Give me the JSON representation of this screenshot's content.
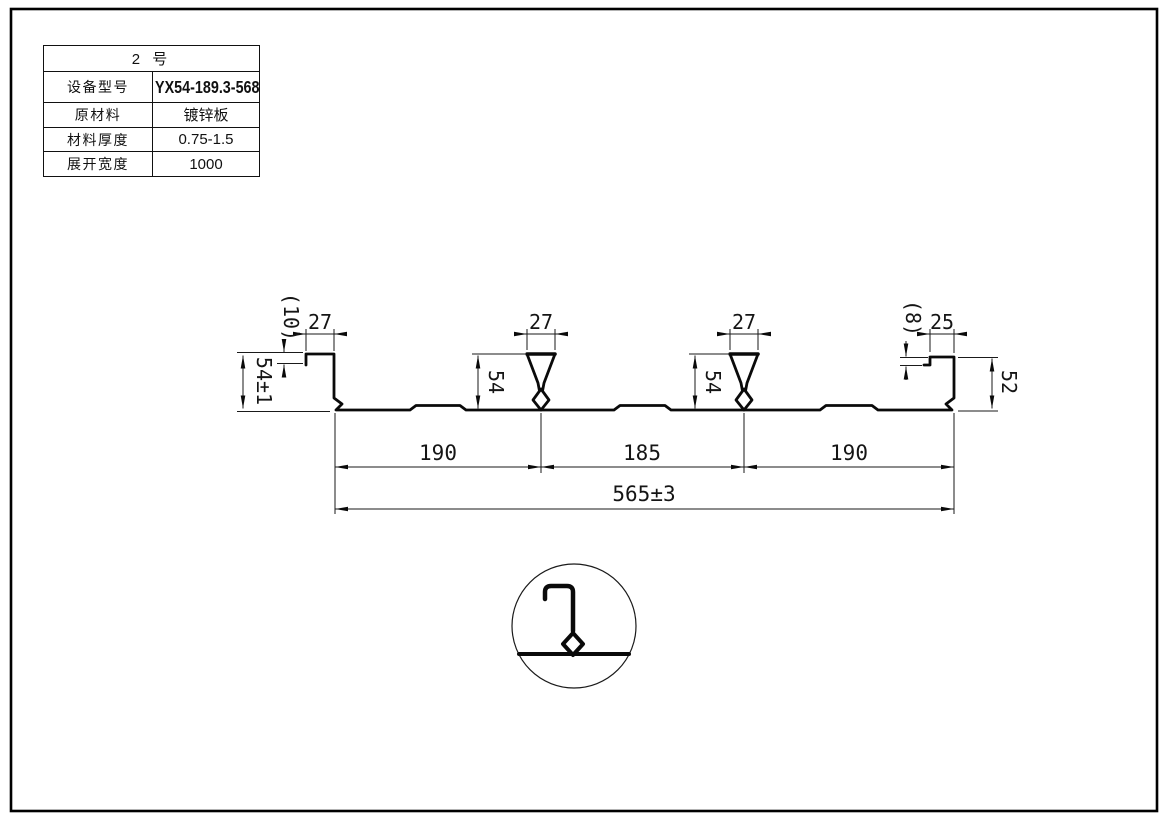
{
  "title_block": {
    "header": "2  号",
    "rows": [
      {
        "label": "设备型号",
        "value": "YX54-189.3-568"
      },
      {
        "label": "原材料",
        "value": "镀锌板"
      },
      {
        "label": "材料厚度",
        "value": "0.75-1.5"
      },
      {
        "label": "展开宽度",
        "value": "1000"
      }
    ]
  },
  "dims": {
    "left_edge_lip": "(10)",
    "left_flange_width": "27",
    "left_edge_height": "54±1",
    "rib1_top_width": "27",
    "rib1_height": "54",
    "rib2_top_width": "27",
    "rib2_height": "54",
    "right_edge_lip": "(8)",
    "right_flange_width": "25",
    "right_edge_height": "52",
    "pitch_left": "190",
    "pitch_center": "185",
    "pitch_right": "190",
    "overall_width": "565±3"
  },
  "colors": {
    "line": "#0a0a0a",
    "background": "#ffffff"
  }
}
